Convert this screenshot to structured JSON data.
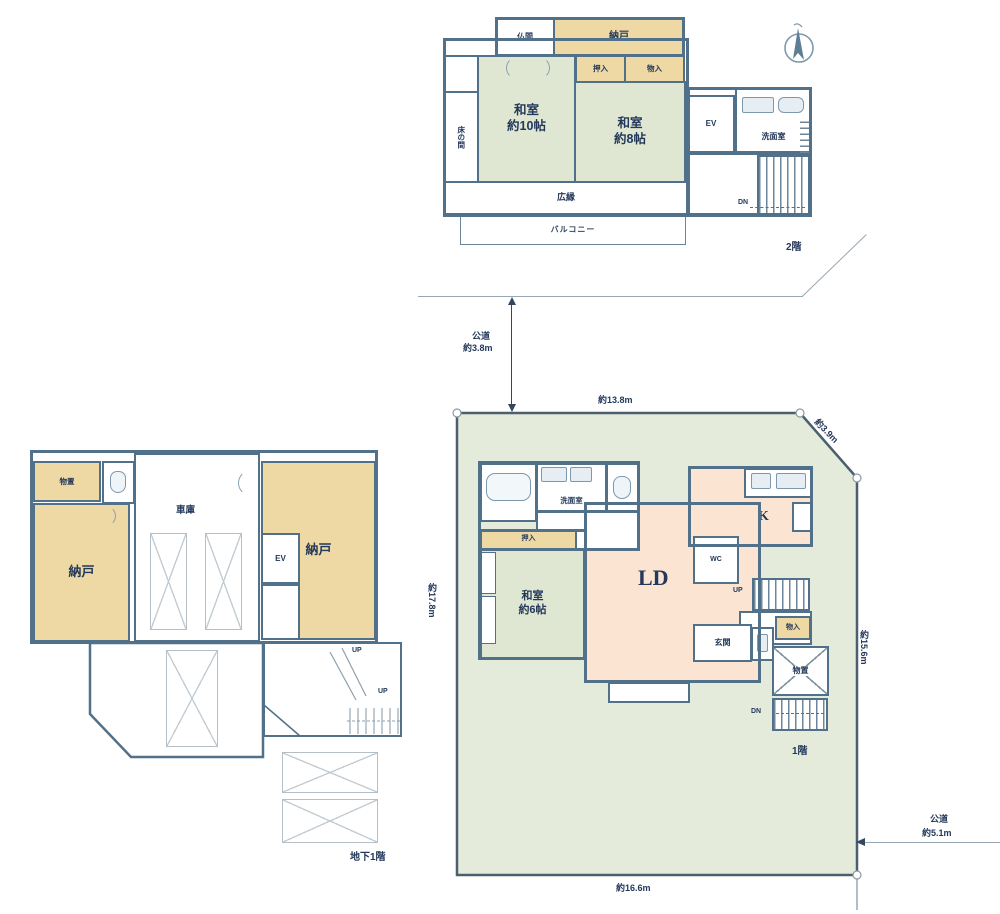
{
  "floor2": {
    "floor_label": "2階",
    "rooms": {
      "butsuma": "仏間",
      "nando": "納戸",
      "oshiire": "押入",
      "monoire": "物入",
      "washitsu10_l1": "和室",
      "washitsu10_l2": "約10帖",
      "washitsu8_l1": "和室",
      "washitsu8_l2": "約8帖",
      "tokonoma": "床の間",
      "hiroen": "広縁",
      "balcony": "バルコニー",
      "ev": "EV",
      "senmenshitsu": "洗面室",
      "dn": "DN"
    }
  },
  "floor1": {
    "floor_label": "1階",
    "rooms": {
      "senmenshitsu": "洗面室",
      "oshiire": "押入",
      "washitsu6_l1": "和室",
      "washitsu6_l2": "約6帖",
      "ld": "LD",
      "k": "K",
      "wc": "WC",
      "up": "UP",
      "dn": "DN",
      "monoire": "物入",
      "genkan": "玄関",
      "monooki": "物置"
    }
  },
  "basement": {
    "floor_label": "地下1階",
    "rooms": {
      "monooki": "物置",
      "shako": "車庫",
      "nando": "納戸",
      "ev": "EV",
      "up": "UP"
    }
  },
  "site": {
    "dim_top": "約13.8m",
    "dim_left": "約17.8m",
    "dim_right": "約15.6m",
    "dim_diagonal": "約3.9m",
    "dim_bottom": "約16.6m",
    "road_left_l1": "公道",
    "road_left_l2": "約3.8m",
    "road_right_l1": "公道",
    "road_right_l2": "約5.1m"
  },
  "colors": {
    "wall": "#51718a",
    "storage_tan": "#eed9a4",
    "tatami_green": "#dfe6d2",
    "ldk_peach": "#fbe4d2",
    "site_green": "#e4ebdb",
    "text_navy": "#23385a"
  }
}
